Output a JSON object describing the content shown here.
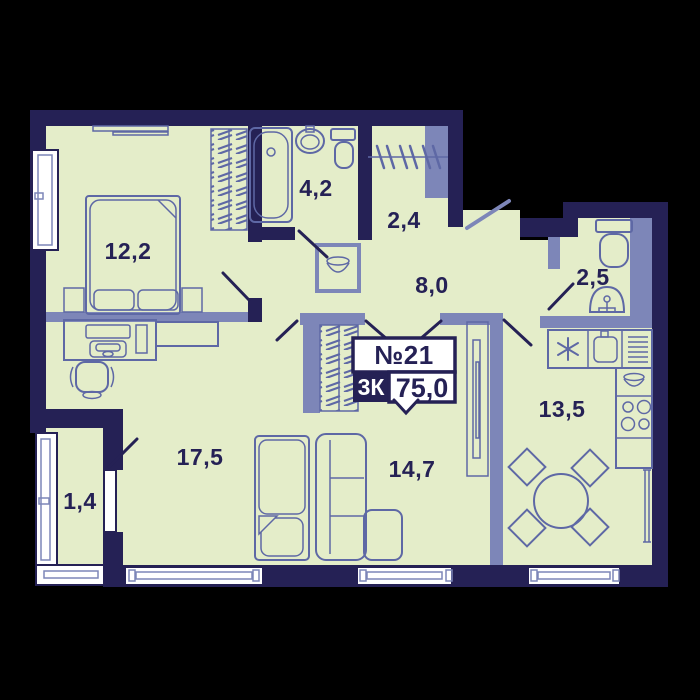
{
  "plan": {
    "badge": {
      "number": "№21",
      "rooms_type": "3К",
      "total_area": "75,0"
    },
    "rooms": {
      "bedroom": {
        "label": "12,2"
      },
      "bathroom": {
        "label": "4,2"
      },
      "storage": {
        "label": "2,4"
      },
      "hallway": {
        "label": "8,0"
      },
      "wc": {
        "label": "2,5"
      },
      "kitchen": {
        "label": "13,5"
      },
      "living": {
        "label": "14,7"
      },
      "bedroom2": {
        "label": "17,5"
      },
      "balcony": {
        "label": "1,4"
      }
    },
    "colors": {
      "background": "#000000",
      "walls": "#252155",
      "floor": "#e4edc9",
      "partitions": "#7d86b8",
      "furniture_lines": "#5e68a5",
      "windows": "#ffffff"
    }
  }
}
